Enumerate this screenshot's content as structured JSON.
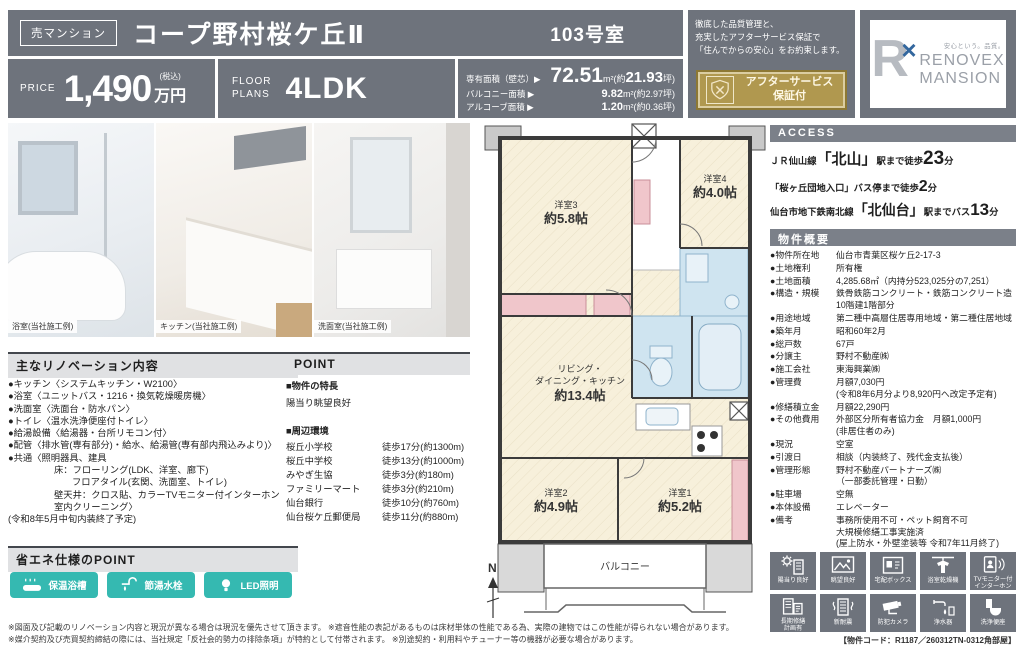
{
  "colors": {
    "header_gray": "#6e737c",
    "accent_teal": "#35b9b1",
    "gold": "#b0984f",
    "plan_cream": "#f7f0db",
    "plan_blue": "#cfe4f0",
    "plan_pink": "#f0c6cb"
  },
  "header": {
    "type_badge": "売マンション",
    "title": "コープ野村桜ケ丘Ⅱ",
    "room_no": "103号室",
    "price": {
      "label": "PRICE",
      "value": "1,490",
      "tax": "(税込)",
      "unit": "万円"
    },
    "floor": {
      "label1": "FLOOR",
      "label2": "PLANS",
      "value": "4LDK"
    },
    "areas": [
      {
        "label": "専有面積（壁芯）▶",
        "num": "72.51",
        "unit": "m²",
        "pre": "(約",
        "tsubo": "21.93",
        "suf": "坪)"
      },
      {
        "label": "バルコニー面積 ▶",
        "num": "9.82",
        "unit": "m²",
        "pre": "(約",
        "tsubo": "2.97",
        "suf": "坪)"
      },
      {
        "label": "アルコーブ面積 ▶",
        "num": "1.20",
        "unit": "m²",
        "pre": "(約",
        "tsubo": "0.36",
        "suf": "坪)"
      }
    ],
    "quality_note": "徹底した品質管理と、\n充実したアフターサービス保証で\n「住んでからの安心」をお約束します。",
    "warranty": {
      "line1": "アフターサービス",
      "line2": "保証付"
    },
    "logo": {
      "mark": "R",
      "cross": "×",
      "tagline": "安心という。品質。",
      "name_top": "RENOVEX",
      "name_bottom": "MANSION"
    }
  },
  "photos": [
    {
      "label": "浴室(当社施工例)"
    },
    {
      "label": "キッチン(当社施工例)"
    },
    {
      "label": "洗面室(当社施工例)"
    }
  ],
  "renovation": {
    "heading": "主なリノベーション内容",
    "lines": [
      "●キッチン〈システムキッチン・W2100〉",
      "●浴室〈ユニットバス・1216・換気乾燥暖房機〉",
      "●洗面室〈洗面台・防水パン〉",
      "●トイレ〈温水洗浄便座付トイレ〉",
      "●給湯設備〈給湯器・台所リモコン付〉",
      "●配管〈排水管(専有部分)・給水、給湯管(専有部内飛込みより)〉",
      "●共通〈照明器具、建具",
      "床：フローリング(LDK、洋室、廊下)",
      "フロアタイル(玄関、洗面室、トイレ)",
      "壁天井：クロス貼、カラーTVモニター付インターホン",
      "室内クリーニング〉",
      "(令和8年5月中旬内装終了予定)"
    ]
  },
  "point": {
    "heading": "POINT",
    "feature_title": "■物件の特長",
    "feature_text": "陽当り眺望良好",
    "env_title": "■周辺環境",
    "places": [
      {
        "name": "桜丘小学校",
        "dist": "徒歩17分(約1300m)"
      },
      {
        "name": "桜丘中学校",
        "dist": "徒歩13分(約1000m)"
      },
      {
        "name": "みやぎ生協",
        "dist": "徒歩3分(約180m)"
      },
      {
        "name": "ファミリーマート",
        "dist": "徒歩3分(約210m)"
      },
      {
        "name": "仙台銀行",
        "dist": "徒歩10分(約760m)"
      },
      {
        "name": "仙台桜ケ丘郵便局",
        "dist": "徒歩11分(約880m)"
      }
    ]
  },
  "eco": {
    "heading": "省エネ仕様のPOINT",
    "badges": [
      {
        "icon": "bathtub-icon",
        "label": "保温浴槽"
      },
      {
        "icon": "faucet-icon",
        "label": "節湯水栓"
      },
      {
        "icon": "led-bulb-icon",
        "label": "LED照明"
      }
    ]
  },
  "floorplan": {
    "rooms": [
      {
        "name": "洋室3",
        "size": "約5.8帖"
      },
      {
        "name": "洋室4",
        "size": "約4.0帖"
      },
      {
        "name": "洋室2",
        "size": "約4.9帖"
      },
      {
        "name": "洋室1",
        "size": "約5.2帖"
      }
    ],
    "ldk": {
      "line1": "リビング・",
      "line2": "ダイニング・キッチン",
      "size": "約13.4帖"
    },
    "balcony": "バルコニー",
    "compass": "N"
  },
  "access": {
    "heading": "ACCESS",
    "route1": {
      "pre": "ＪＲ仙山線",
      "station": "「北山」",
      "mid": "駅まで徒歩",
      "num": "23",
      "suf": "分"
    },
    "route2": {
      "pre": "「桜ヶ丘団地入口」バス停まで徒歩",
      "num": "2",
      "suf": "分"
    },
    "route3": {
      "pre": "仙台市地下鉄南北線",
      "station": "「北仙台」",
      "mid": "駅までバス",
      "num": "13",
      "suf": "分"
    }
  },
  "outline": {
    "heading": "物件概要",
    "rows": [
      {
        "label": "●物件所在地",
        "value": "仙台市青葉区桜ケ丘2-17-3"
      },
      {
        "label": "●土地権利",
        "value": "所有権"
      },
      {
        "label": "●土地面積",
        "value": "4,285.68㎡（内持分523,025分の7,251）"
      },
      {
        "label": "●構造・規模",
        "value": "鉄骨鉄筋コンクリート・鉄筋コンクリート造\n10階建1階部分"
      },
      {
        "label": "●用途地域",
        "value": "第二種中高層住居専用地域・第二種住居地域"
      },
      {
        "label": "●築年月",
        "value": "昭和60年2月"
      },
      {
        "label": "●総戸数",
        "value": "67戸"
      },
      {
        "label": "●分譲主",
        "value": "野村不動産㈱"
      },
      {
        "label": "●施工会社",
        "value": "東海興業㈱"
      },
      {
        "label": "●管理費",
        "value": "月額7,030円\n(令和8年6月分より8,920円へ改定予定有)"
      },
      {
        "label": "●修繕積立金",
        "value": "月額22,290円"
      },
      {
        "label": "●その他費用",
        "value": "外部区分所有者協力金　月額1,000円\n(非居住者のみ)"
      },
      {
        "label": "●現況",
        "value": "空室"
      },
      {
        "label": "●引渡日",
        "value": "相談（内装終了、残代金支払後）"
      },
      {
        "label": "●管理形態",
        "value": "野村不動産パートナーズ㈱\n（一部委託管理・日勤）"
      },
      {
        "label": "●駐車場",
        "value": "空無"
      },
      {
        "label": "●本体設備",
        "value": "エレベーター"
      },
      {
        "label": "●備考",
        "value": "事務所使用不可・ペット飼育不可\n大規模修繕工事実施済\n(屋上防水・外壁塗装等 令和7年11月終了)"
      }
    ]
  },
  "features": {
    "items": [
      {
        "icon": "sun-building-icon",
        "label": "陽当り良好"
      },
      {
        "icon": "view-icon",
        "label": "眺望良好"
      },
      {
        "icon": "delivery-box-icon",
        "label": "宅配ボックス"
      },
      {
        "icon": "bath-dryer-icon",
        "label": "浴室乾燥機"
      },
      {
        "icon": "tv-intercom-icon",
        "label": "TVモニター付\nインターホン"
      },
      {
        "icon": "repair-plan-icon",
        "label": "長期修繕\n計画有"
      },
      {
        "icon": "earthquake-icon",
        "label": "新耐震"
      },
      {
        "icon": "security-camera-icon",
        "label": "防犯カメラ"
      },
      {
        "icon": "water-purifier-icon",
        "label": "浄水器"
      },
      {
        "icon": "washlet-icon",
        "label": "洗浄便座"
      }
    ],
    "code": "【物件コード：R1187／260312TN-0312角部屋】"
  },
  "footer": {
    "line1": "※図面及び記載のリノベーション内容と現況が異なる場合は現況を優先させて頂きます。 ※遮音性能の表記があるものは床材単体の性能である為、実際の建物ではこの性能が得られない場合があります。",
    "line2": "※媒介契約及び売買契約締結の際には、当社規定「反社会的勢力の排除条項」が特約として付帯されます。 ※別途契約・利用料やチューナー等の機器が必要な場合があります。"
  }
}
